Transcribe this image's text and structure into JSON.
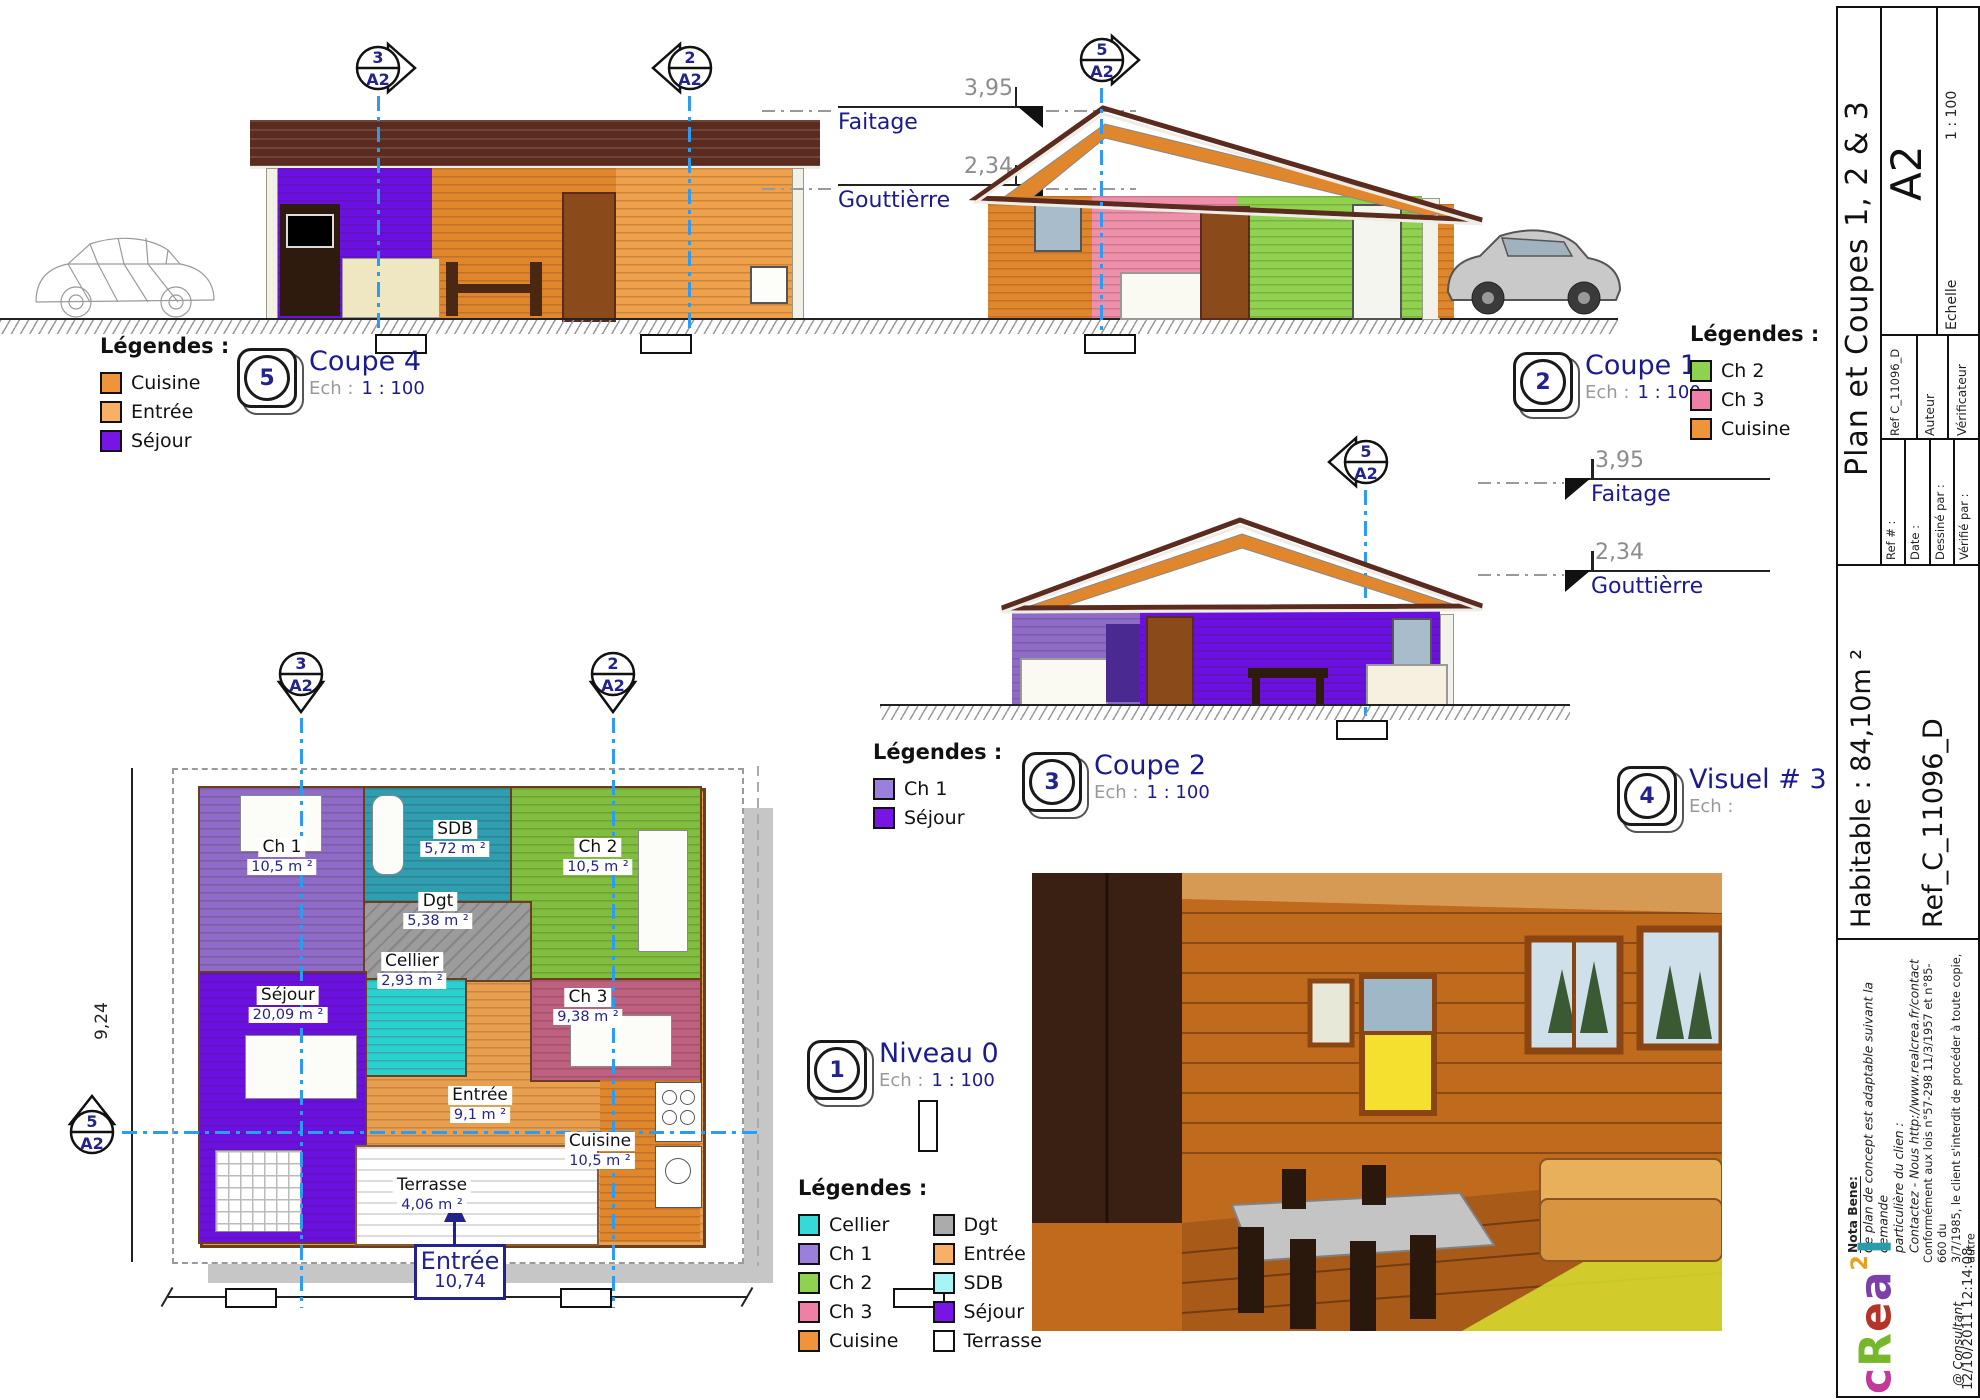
{
  "markers": {
    "m2": {
      "num": "2",
      "sheet": "A2"
    },
    "m3": {
      "num": "3",
      "sheet": "A2"
    },
    "m5": {
      "num": "5",
      "sheet": "A2"
    }
  },
  "dims": {
    "faitage_value": "3,95",
    "faitage_label": "Faitage",
    "gouttiere_value": "2,34",
    "gouttiere_label": "Gouttièrre"
  },
  "panels": {
    "coupe4": {
      "badge": "5",
      "title": "Coupe 4",
      "ech_label": "Ech :",
      "scale": "1 : 100"
    },
    "coupe1": {
      "badge": "2",
      "title": "Coupe 1",
      "ech_label": "Ech :",
      "scale": "1 : 100"
    },
    "coupe2": {
      "badge": "3",
      "title": "Coupe 2",
      "ech_label": "Ech :",
      "scale": "1 : 100"
    },
    "visuel3": {
      "badge": "4",
      "title": "Visuel # 3",
      "ech_label": "Ech :",
      "scale": ""
    },
    "niveau0": {
      "badge": "1",
      "title": "Niveau 0",
      "ech_label": "Ech :",
      "scale": "1 : 100"
    }
  },
  "legends": {
    "coupe4": {
      "title": "Légendes :",
      "items": [
        {
          "label": "Cuisine",
          "color": "#F0943C"
        },
        {
          "label": "Entrée",
          "color": "#F8B066"
        },
        {
          "label": "Séjour",
          "color": "#7814E6"
        }
      ]
    },
    "coupe1": {
      "title": "Légendes :",
      "items": [
        {
          "label": "Ch 2",
          "color": "#8FD24F"
        },
        {
          "label": "Ch 3",
          "color": "#F07FA8"
        },
        {
          "label": "Cuisine",
          "color": "#F0943C"
        }
      ]
    },
    "coupe2": {
      "title": "Légendes :",
      "items": [
        {
          "label": "Ch 1",
          "color": "#9B7FDC"
        },
        {
          "label": "Séjour",
          "color": "#7814E6"
        }
      ]
    },
    "plan": {
      "title": "Légendes :",
      "col1": [
        {
          "label": "Cellier",
          "color": "#35D9D9"
        },
        {
          "label": "Ch 1",
          "color": "#9B7FDC"
        },
        {
          "label": "Ch 2",
          "color": "#8FD24F"
        },
        {
          "label": "Ch 3",
          "color": "#F07FA8"
        },
        {
          "label": "Cuisine",
          "color": "#F0943C"
        }
      ],
      "col2": [
        {
          "label": "Dgt",
          "color": "#ABABAB"
        },
        {
          "label": "Entrée",
          "color": "#F8B066"
        },
        {
          "label": "SDB",
          "color": "#A8F4F4"
        },
        {
          "label": "Séjour",
          "color": "#7814E6"
        },
        {
          "label": "Terrasse",
          "color": "#FFFFFF"
        }
      ]
    }
  },
  "plan": {
    "rooms": {
      "ch1": {
        "name": "Ch 1",
        "area": "10,5 m ²"
      },
      "sdb": {
        "name": "SDB",
        "area": "5,72 m ²"
      },
      "ch2": {
        "name": "Ch 2",
        "area": "10,5 m ²"
      },
      "dgt": {
        "name": "Dgt",
        "area": "5,38 m ²"
      },
      "cellier": {
        "name": "Cellier",
        "area": "2,93 m ²"
      },
      "sejour": {
        "name": "Séjour",
        "area": "20,09 m ²"
      },
      "ch3": {
        "name": "Ch 3",
        "area": "9,38 m ²"
      },
      "entree": {
        "name": "Entrée",
        "area": "9,1 m ²"
      },
      "cuisine": {
        "name": "Cuisine",
        "area": "10,5 m ²"
      },
      "terrasse": {
        "name": "Terrasse",
        "area": "4,06 m ²"
      }
    },
    "dim_height": "9,24",
    "entrance": {
      "label": "Entrée",
      "value": "10,74"
    }
  },
  "titleblock": {
    "sheet_format": "A2",
    "scale": "1 : 100",
    "echelle_label": "Echelle",
    "auteur_label": "Auteur",
    "verificateur_label": "Vérificateur",
    "ref_small": "Ref C_11096_D",
    "title": "Plan et Coupes 1, 2 & 3",
    "ref_num_label": "Ref # :",
    "date_label": "Date :",
    "dessine_label": "Dessiné par :",
    "verifie_label": "Vérifié par :",
    "habitable": "Habitable : 84,10m ²",
    "ref_big": "Ref_C_11096_D",
    "nota_title": "Nota Bene:",
    "nota_lines": [
      "Ce plan de concept est adaptable suivant la demande",
      "particulière du clien :",
      "Contactez - Nous http://www.realcrea.fr/contact"
    ],
    "legal_lines": [
      "Conformément aux lois n°57-298 11/3/1957 et n°85-660 du",
      "3/7/1985, le client s'interdit de procéder à toute copie, autre",
      "que celles autorisées dans le cadre d'utilisation personnelle"
    ],
    "consultant": "@ Consultant",
    "datetime": "12/10/2011 12:14:08",
    "logo": {
      "letters": [
        {
          "ch": "c",
          "color": "#C2399B"
        },
        {
          "ch": "R",
          "color": "#76B82A"
        },
        {
          "ch": "e",
          "color": "#B5342A"
        },
        {
          "ch": "a",
          "color": "#7D3FA8"
        }
      ],
      "sup": {
        "ch": "2",
        "color": "#E8A01E"
      },
      "last": {
        "ch": "l",
        "color": "#2A9BA8"
      }
    }
  }
}
